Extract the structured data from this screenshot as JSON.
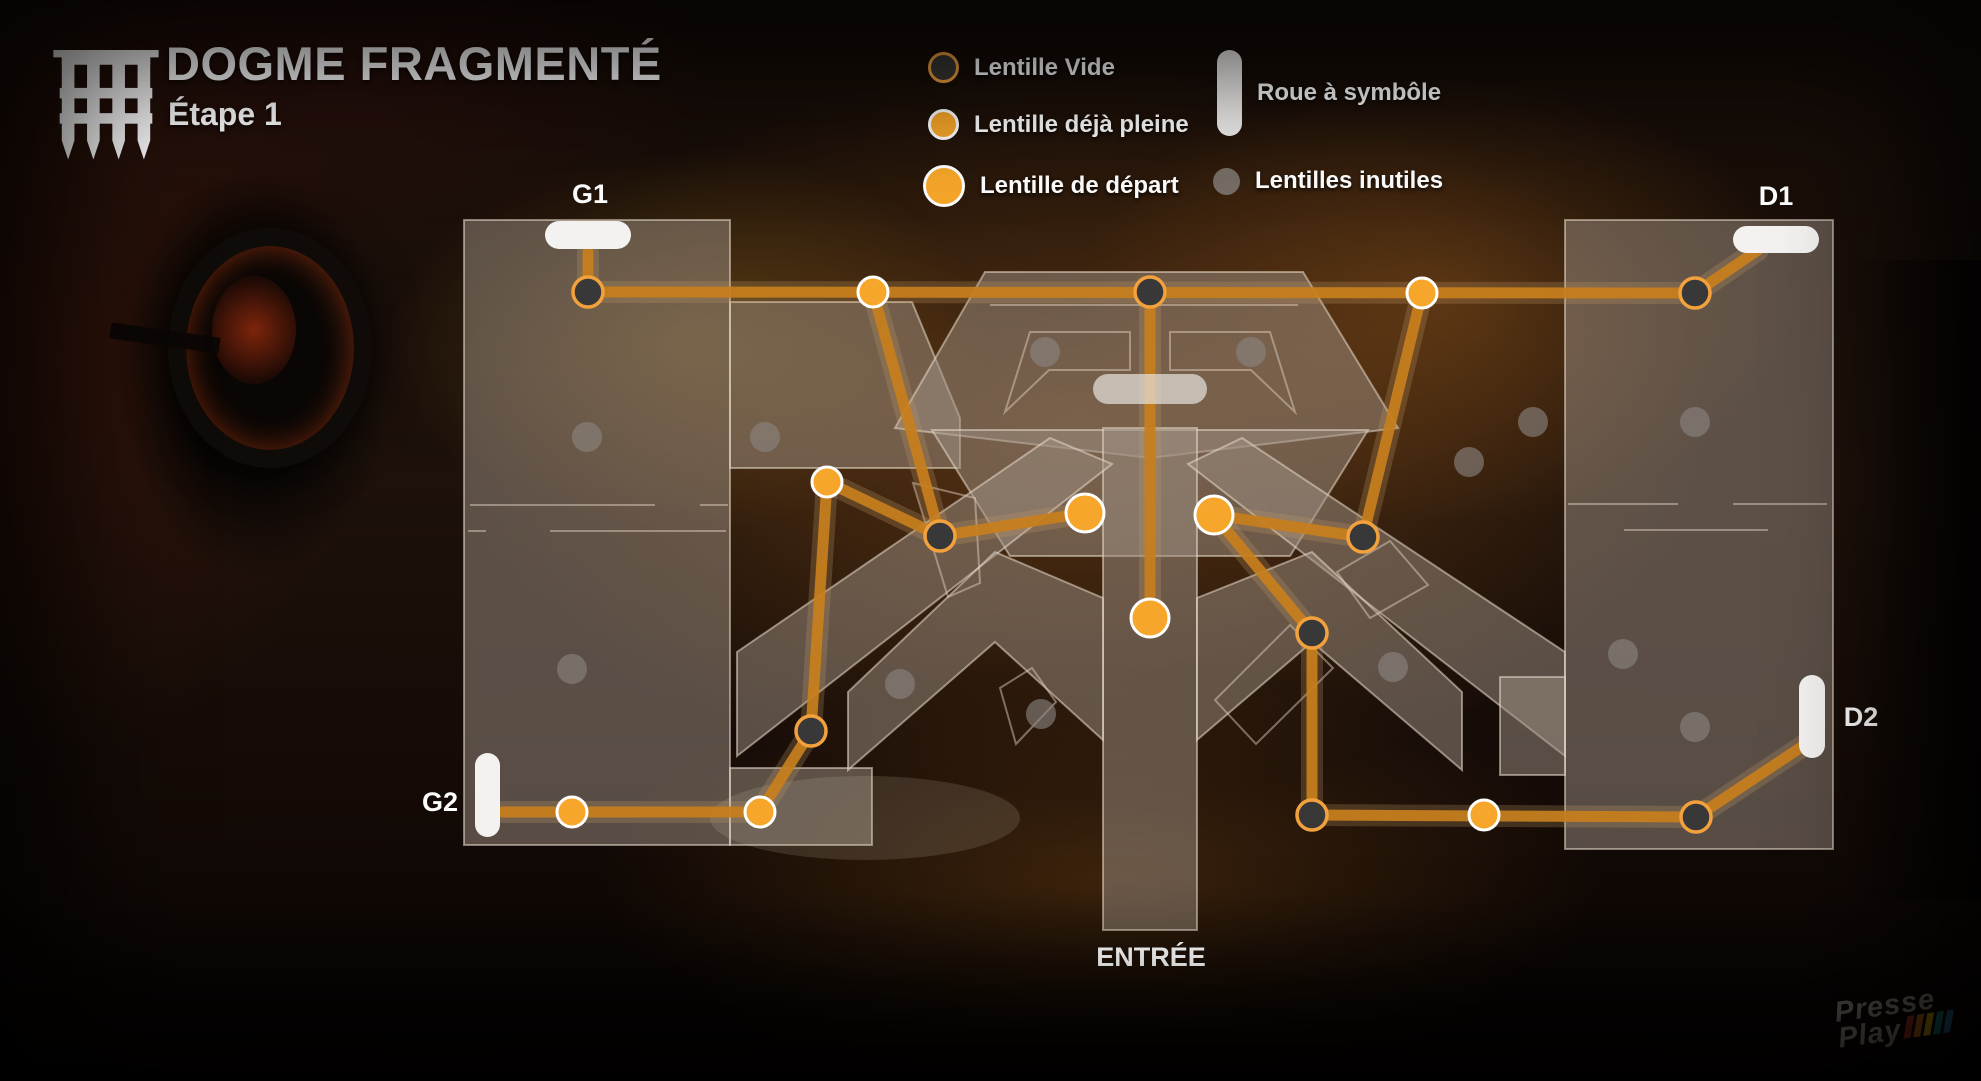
{
  "title": {
    "main": "DOGME FRAGMENTÉ",
    "subtitle": "Étape 1"
  },
  "legend": {
    "items": [
      {
        "id": "vide",
        "label": "Lentille Vide"
      },
      {
        "id": "pleine",
        "label": "Lentille déjà pleine"
      },
      {
        "id": "depart",
        "label": "Lentille de départ"
      },
      {
        "id": "roue",
        "label": "Roue à symbôle"
      },
      {
        "id": "inutiles",
        "label": "Lentilles inutiles"
      }
    ]
  },
  "watermark": {
    "line1": "Presse",
    "line2": "Play",
    "bar_colors": [
      "#a93226",
      "#ca6f1e",
      "#d4ac0d",
      "#16827a",
      "#2471a3"
    ]
  },
  "colors": {
    "accent_orange": "#f6a62a",
    "path_orange": "#c77f1d",
    "node_dark": "#383838",
    "pill_white": "#f4f2f0",
    "text": "#ffffff"
  },
  "map": {
    "style": {
      "fill": "rgba(158,144,132,0.50)",
      "stroke": "rgba(232,219,203,0.55)",
      "deco_stroke": "rgba(225,210,192,0.48)",
      "path": "#c77f1d",
      "path_under": "rgba(195,155,105,0.25)",
      "node_types": {
        "vide": {
          "fill": "#383838",
          "stroke": "#f2a13c",
          "sw": 3.5,
          "r": 15,
          "opacity": 1
        },
        "pleine": {
          "fill": "#f6a62a",
          "stroke": "#ffffff",
          "sw": 3,
          "r": 15,
          "opacity": 1
        },
        "depart": {
          "fill": "#f6a62a",
          "stroke": "#ffffff",
          "sw": 3,
          "r": 19,
          "opacity": 1
        },
        "inutile": {
          "fill": "#8b8580",
          "stroke": "none",
          "sw": 0,
          "r": 15,
          "opacity": 0.62
        }
      }
    },
    "shapes": [
      {
        "id": "left-slab",
        "points": "464,220 730,220 730,845 464,845"
      },
      {
        "id": "left-arm",
        "points": "730,302 912,302 960,418 960,468 730,468"
      },
      {
        "id": "left-foot",
        "points": "730,768 872,768 872,845 730,845"
      },
      {
        "id": "top-hexagon",
        "points": "985,272 1303,272 1398,428 1150,458 895,428"
      },
      {
        "id": "center-block",
        "points": "932,430 1368,430 1290,556 1010,556"
      },
      {
        "id": "corridor",
        "points": "1103,428 1197,428 1197,930 1103,930"
      },
      {
        "id": "band-right",
        "points": "1242,438 1565,652 1565,756 1188,464"
      },
      {
        "id": "band-left",
        "points": "1050,438 737,652 737,756 1112,464"
      },
      {
        "id": "chevron-right",
        "points": "1197,598 1312,552 1462,692 1462,770 1312,642 1197,740"
      },
      {
        "id": "chevron-left",
        "points": "1103,598 995,552 848,692 848,770 995,642 1103,740"
      },
      {
        "id": "right-slab",
        "points": "1565,220 1833,220 1833,849 1565,849"
      },
      {
        "id": "right-notch",
        "points": "1500,677 1565,677 1565,775 1500,775"
      }
    ],
    "deco_polys": [
      {
        "id": "inner-left",
        "points": "1030,332 1130,332 1130,370 1049,370 1005,412"
      },
      {
        "id": "inner-right",
        "points": "1270,332 1170,332 1170,370 1251,370 1295,412"
      },
      {
        "id": "tilted-quad-a",
        "points": "913,483 975,498 980,583 948,597"
      },
      {
        "id": "tilted-quad-b",
        "points": "1337,572 1390,541 1428,585 1370,618"
      },
      {
        "id": "tilted-quad-c",
        "points": "1000,688 1032,668 1056,702 1016,744"
      },
      {
        "id": "chevron-outline",
        "points": "1215,700 1290,625 1333,668 1256,744"
      }
    ],
    "deco_lines": [
      [
        470,
        505,
        655,
        505
      ],
      [
        700,
        505,
        728,
        505
      ],
      [
        468,
        531,
        486,
        531
      ],
      [
        550,
        531,
        726,
        531
      ],
      [
        1568,
        504,
        1678,
        504
      ],
      [
        1733,
        504,
        1827,
        504
      ],
      [
        1624,
        530,
        1768,
        530
      ],
      [
        990,
        305,
        1298,
        305
      ]
    ],
    "floor_ellipse": {
      "cx": 865,
      "cy": 818,
      "rx": 155,
      "ry": 42,
      "fill": "rgba(215,205,185,0.15)"
    },
    "edges": [
      {
        "id": "g1-pill-link",
        "points": [
          588,
          252,
          588,
          292
        ]
      },
      {
        "id": "top-line",
        "points": [
          588,
          292,
          1695,
          293
        ]
      },
      {
        "id": "d1-pill-link",
        "points": [
          1695,
          293,
          1758,
          250
        ]
      },
      {
        "id": "p1-to-v4",
        "points": [
          873,
          292,
          940,
          536
        ]
      },
      {
        "id": "v4-to-s1",
        "points": [
          940,
          536,
          1085,
          513
        ]
      },
      {
        "id": "p3-to-v4",
        "points": [
          827,
          482,
          940,
          536
        ]
      },
      {
        "id": "p3-to-v6",
        "points": [
          827,
          482,
          811,
          731
        ]
      },
      {
        "id": "v6-to-p5",
        "points": [
          811,
          731,
          760,
          812
        ]
      },
      {
        "id": "g2-line",
        "points": [
          498,
          812,
          760,
          812
        ]
      },
      {
        "id": "center-vertical",
        "points": [
          1150,
          292,
          1150,
          618
        ]
      },
      {
        "id": "p2-to-v5",
        "points": [
          1422,
          293,
          1363,
          537
        ]
      },
      {
        "id": "s2-to-v5",
        "points": [
          1214,
          515,
          1363,
          537
        ]
      },
      {
        "id": "s2-to-v7",
        "points": [
          1214,
          515,
          1312,
          633
        ]
      },
      {
        "id": "v7-to-v8",
        "points": [
          1312,
          633,
          1312,
          815
        ]
      },
      {
        "id": "v8-to-v9",
        "points": [
          1312,
          815,
          1696,
          817
        ]
      },
      {
        "id": "d2-pill-link",
        "points": [
          1696,
          817,
          1806,
          744
        ]
      }
    ],
    "nodes": [
      {
        "type": "vide",
        "x": 588,
        "y": 292
      },
      {
        "type": "vide",
        "x": 1150,
        "y": 292
      },
      {
        "type": "vide",
        "x": 1695,
        "y": 293
      },
      {
        "type": "vide",
        "x": 940,
        "y": 536
      },
      {
        "type": "vide",
        "x": 1363,
        "y": 537
      },
      {
        "type": "vide",
        "x": 811,
        "y": 731
      },
      {
        "type": "vide",
        "x": 1312,
        "y": 633
      },
      {
        "type": "vide",
        "x": 1312,
        "y": 815
      },
      {
        "type": "vide",
        "x": 1696,
        "y": 817
      },
      {
        "type": "pleine",
        "x": 873,
        "y": 292
      },
      {
        "type": "pleine",
        "x": 1422,
        "y": 293
      },
      {
        "type": "pleine",
        "x": 827,
        "y": 482
      },
      {
        "type": "pleine",
        "x": 572,
        "y": 812
      },
      {
        "type": "pleine",
        "x": 760,
        "y": 812
      },
      {
        "type": "pleine",
        "x": 1484,
        "y": 815
      },
      {
        "type": "depart",
        "x": 1085,
        "y": 513
      },
      {
        "type": "depart",
        "x": 1214,
        "y": 515
      },
      {
        "type": "depart",
        "x": 1150,
        "y": 618
      },
      {
        "type": "inutile",
        "x": 587,
        "y": 437
      },
      {
        "type": "inutile",
        "x": 765,
        "y": 437
      },
      {
        "type": "inutile",
        "x": 1045,
        "y": 352
      },
      {
        "type": "inutile",
        "x": 1251,
        "y": 352
      },
      {
        "type": "inutile",
        "x": 572,
        "y": 669
      },
      {
        "type": "inutile",
        "x": 900,
        "y": 684
      },
      {
        "type": "inutile",
        "x": 1041,
        "y": 714
      },
      {
        "type": "inutile",
        "x": 1393,
        "y": 667
      },
      {
        "type": "inutile",
        "x": 1469,
        "y": 462
      },
      {
        "type": "inutile",
        "x": 1533,
        "y": 422
      },
      {
        "type": "inutile",
        "x": 1695,
        "y": 422
      },
      {
        "type": "inutile",
        "x": 1623,
        "y": 654
      },
      {
        "type": "inutile",
        "x": 1695,
        "y": 727
      }
    ],
    "pills": [
      {
        "id": "roue-g1",
        "x": 545,
        "y": 221,
        "w": 86,
        "h": 28,
        "variant": "white"
      },
      {
        "id": "roue-d1",
        "x": 1733,
        "y": 226,
        "w": 86,
        "h": 27,
        "variant": "white"
      },
      {
        "id": "roue-g2",
        "x": 475,
        "y": 753,
        "w": 25,
        "h": 84,
        "variant": "white"
      },
      {
        "id": "roue-d2",
        "x": 1799,
        "y": 675,
        "w": 26,
        "h": 83,
        "variant": "white"
      },
      {
        "id": "roue-center",
        "x": 1093,
        "y": 374,
        "w": 114,
        "h": 30,
        "variant": "gray"
      }
    ],
    "labels": [
      {
        "id": "g1",
        "text": "G1",
        "x": 590,
        "y": 203
      },
      {
        "id": "d1",
        "text": "D1",
        "x": 1776,
        "y": 205
      },
      {
        "id": "g2",
        "text": "G2",
        "x": 440,
        "y": 811
      },
      {
        "id": "d2",
        "text": "D2",
        "x": 1861,
        "y": 726
      },
      {
        "id": "entree",
        "text": "ENTRÉE",
        "x": 1151,
        "y": 966
      }
    ]
  }
}
